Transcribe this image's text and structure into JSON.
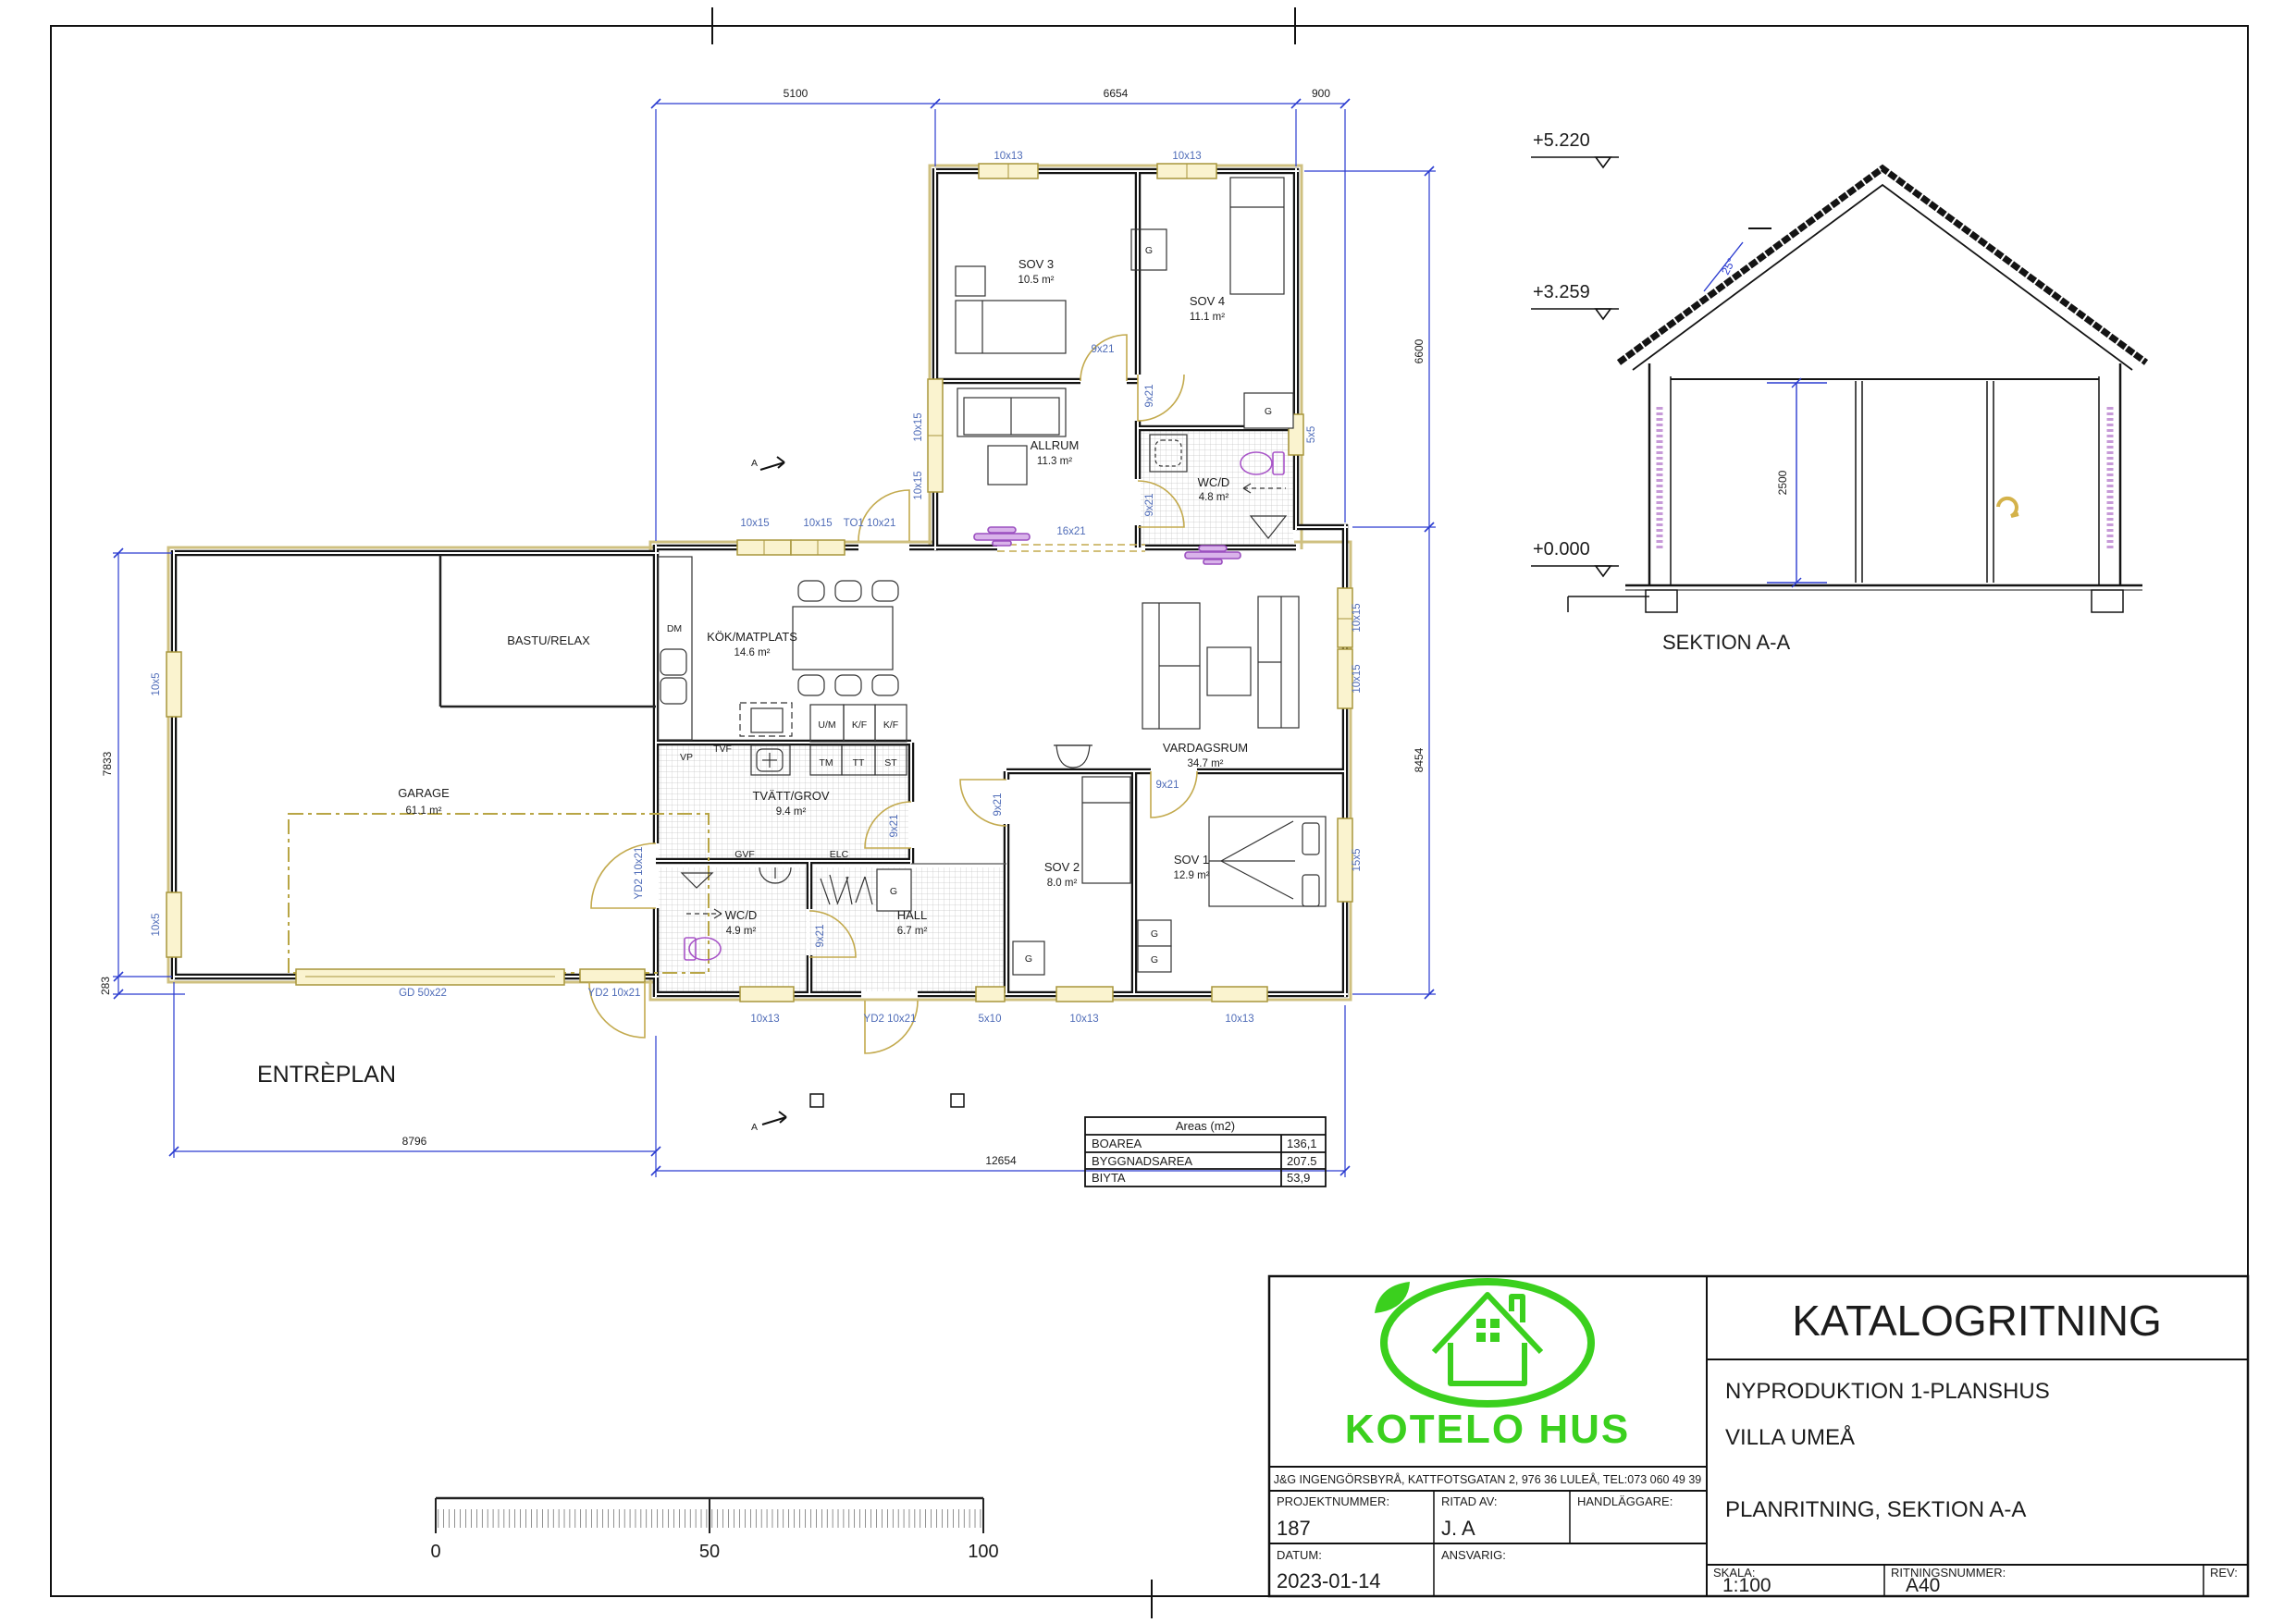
{
  "plan": {
    "title": "ENTRÈPLAN",
    "rooms": {
      "sov3": {
        "name": "SOV 3",
        "area": "10.5 m²"
      },
      "sov4": {
        "name": "SOV 4",
        "area": "11.1 m²"
      },
      "allrum": {
        "name": "ALLRUM",
        "area": "11.3 m²"
      },
      "wcd_upper": {
        "name": "WC/D",
        "area": "4.8 m²"
      },
      "kok": {
        "name": "KÖK/MATPLATS",
        "area": "14.6 m²"
      },
      "vardagsrum": {
        "name": "VARDAGSRUM",
        "area": "34.7 m²"
      },
      "tvatt": {
        "name": "TVÄTT/GROV",
        "area": "9.4 m²"
      },
      "wcd_lower": {
        "name": "WC/D",
        "area": "4.9 m²"
      },
      "hall": {
        "name": "HALL",
        "area": "6.7 m²"
      },
      "sov2": {
        "name": "SOV 2",
        "area": "8.0 m²"
      },
      "sov1": {
        "name": "SOV 1",
        "area": "12.9 m²"
      },
      "garage": {
        "name": "GARAGE",
        "area": "61.1 m²"
      },
      "bastu": {
        "name": "BASTU/RELAX"
      }
    },
    "openings": {
      "w10x13": "10x13",
      "w10x15": "10x15",
      "d9x21": "9x21",
      "to1": "TO1 10x21",
      "o16x21": "16x21",
      "w5x5": "5x5",
      "w15x5": "15x5",
      "w5x10": "5x10",
      "yd2": "YD2 10x21",
      "gd": "GD 50x22",
      "w10x5": "10x5"
    },
    "appliances": {
      "dm": "DM",
      "um": "U/M",
      "kf": "K/F",
      "tm": "TM",
      "tt": "TT",
      "st": "ST",
      "vp": "VP",
      "tvf": "TVF",
      "gvf": "GVF",
      "elc": "ELC",
      "g": "G"
    },
    "dims": {
      "top1": "5100",
      "top2": "6654",
      "top3": "900",
      "right1": "6600",
      "right2": "8454",
      "left1": "7833",
      "left2": "283",
      "bottom1": "8796",
      "bottom2": "12654"
    },
    "section_mark": "A"
  },
  "section": {
    "title": "SEKTION A-A",
    "level_top": "+5.220",
    "level_eave": "+3.259",
    "level_ground": "+0.000",
    "room_height": "2500",
    "roof_angle": "25°"
  },
  "areas_table": {
    "title": "Areas (m2)",
    "rows": [
      {
        "label": "BOAREA",
        "value": "136,1"
      },
      {
        "label": "BYGGNADSAREA",
        "value": "207.5"
      },
      {
        "label": "BIYTA",
        "value": "53,9"
      }
    ]
  },
  "scalebar": {
    "t0": "0",
    "t50": "50",
    "t100": "100"
  },
  "titleblock": {
    "logo_text": "KOTELO HUS",
    "address": "J&G INGENGÖRSBYRÅ, KATTFOTSGATAN 2, 976 36 LULEÅ, TEL:073 060 49 39",
    "title": "KATALOGRITNING",
    "subtitle1": "NYPRODUKTION 1-PLANSHUS",
    "subtitle2": "VILLA UMEÅ",
    "subtitle3": "PLANRITNING, SEKTION A-A",
    "fields": {
      "projektnummer_label": "PROJEKTNUMMER:",
      "projektnummer": "187",
      "ritad_label": "RITAD AV:",
      "ritad": "J. A",
      "handlaggare_label": "HANDLÄGGARE:",
      "datum_label": "DATUM:",
      "datum": "2023-01-14",
      "ansvarig_label": "ANSVARIG:",
      "skala_label": "SKALA:",
      "skala": "1:100",
      "ritningsnummer_label": "RITNINGSNUMMER:",
      "ritningsnummer": "A40",
      "rev_label": "REV:"
    }
  },
  "colors": {
    "accent_green": "#3bd01e",
    "label_blue": "#4f6cb8",
    "dim_blue": "#2a3bd0",
    "wood_yellow": "#c3aa4e",
    "fixture_purple": "#a855c8"
  }
}
